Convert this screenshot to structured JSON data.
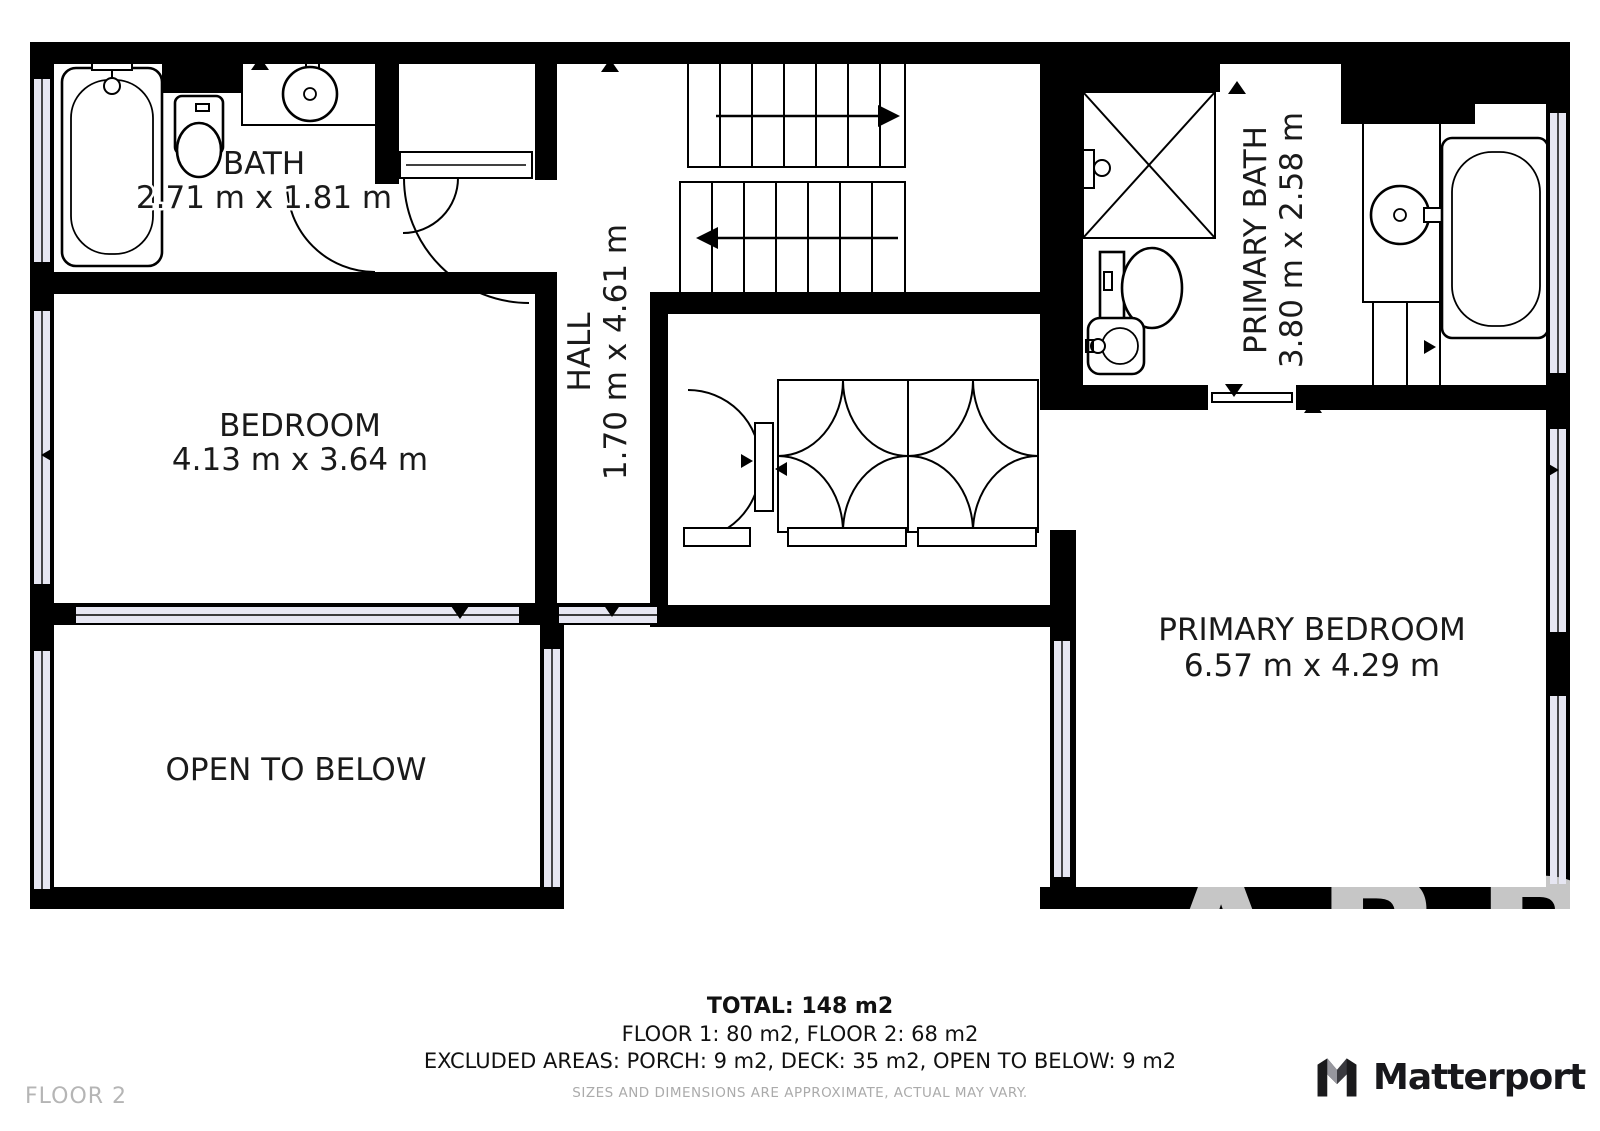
{
  "floor_label": "FLOOR 2",
  "watermark": "ARB",
  "brand": {
    "name": "Matterport",
    "icon": "matterport-m-cube-icon"
  },
  "plan": {
    "rooms": [
      {
        "name": "BATH",
        "dims": "2.71 m x 1.81 m"
      },
      {
        "name": "BEDROOM",
        "dims": "4.13 m x 3.64 m"
      },
      {
        "name": "HALL",
        "dims": "1.70 m x 4.61 m"
      },
      {
        "name": "PRIMARY BATH",
        "dims": "3.80 m x 2.58 m"
      },
      {
        "name": "PRIMARY BEDROOM",
        "dims": "6.57 m x 4.29 m"
      },
      {
        "name": "OPEN TO BELOW",
        "dims": ""
      }
    ],
    "fixtures": [
      "bathtub-icon",
      "shower-icon",
      "toilet-icon",
      "round-sink-icon",
      "vanity-counter-icon",
      "stairs-up-arrow-icon",
      "stairs-down-arrow-icon",
      "door-swing-arc-icon",
      "closet-bifold-doors-icon",
      "window-icon",
      "door-direction-marker-icon"
    ]
  },
  "summary": {
    "total": "TOTAL: 148 m2",
    "floors": "FLOOR 1: 80 m2, FLOOR 2: 68 m2",
    "excluded": "EXCLUDED AREAS: PORCH: 9 m2, DECK: 35 m2, OPEN TO BELOW: 9 m2",
    "disclaimer": "SIZES AND DIMENSIONS ARE APPROXIMATE, ACTUAL MAY VARY."
  },
  "colors": {
    "wall": "#000000",
    "window_fill": "#e6e6f2",
    "label_text": "#1a1a1a",
    "muted_text": "#ababab",
    "floor_label_text": "#b5b5b5",
    "watermark": "#c6c6c6",
    "brand_text": "#18181c"
  }
}
